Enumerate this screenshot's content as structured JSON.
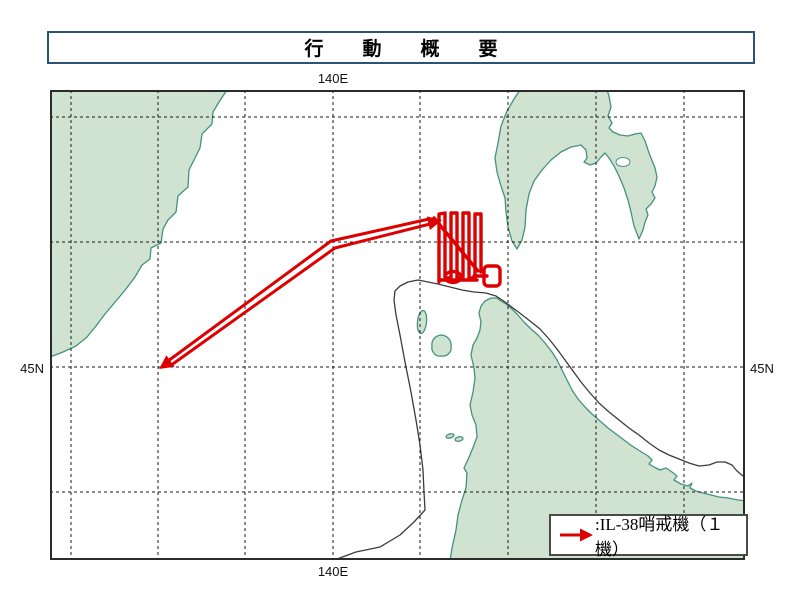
{
  "title": "行　動　概　要",
  "map": {
    "meridian_label_top": "140E",
    "meridian_label_bottom": "140E",
    "parallel_label_left": "45N",
    "parallel_label_right": "45N",
    "legend": {
      "label": ":IL-38哨戒機（１機）"
    }
  },
  "colors": {
    "track_red": "#dd0000",
    "land_green": "#d0e3d1",
    "coast_teal": "#44917f",
    "title_border_navy": "#2d5177",
    "boundary_line_gray": "#3c3c3c",
    "grid_black": "#1a1a1a"
  }
}
